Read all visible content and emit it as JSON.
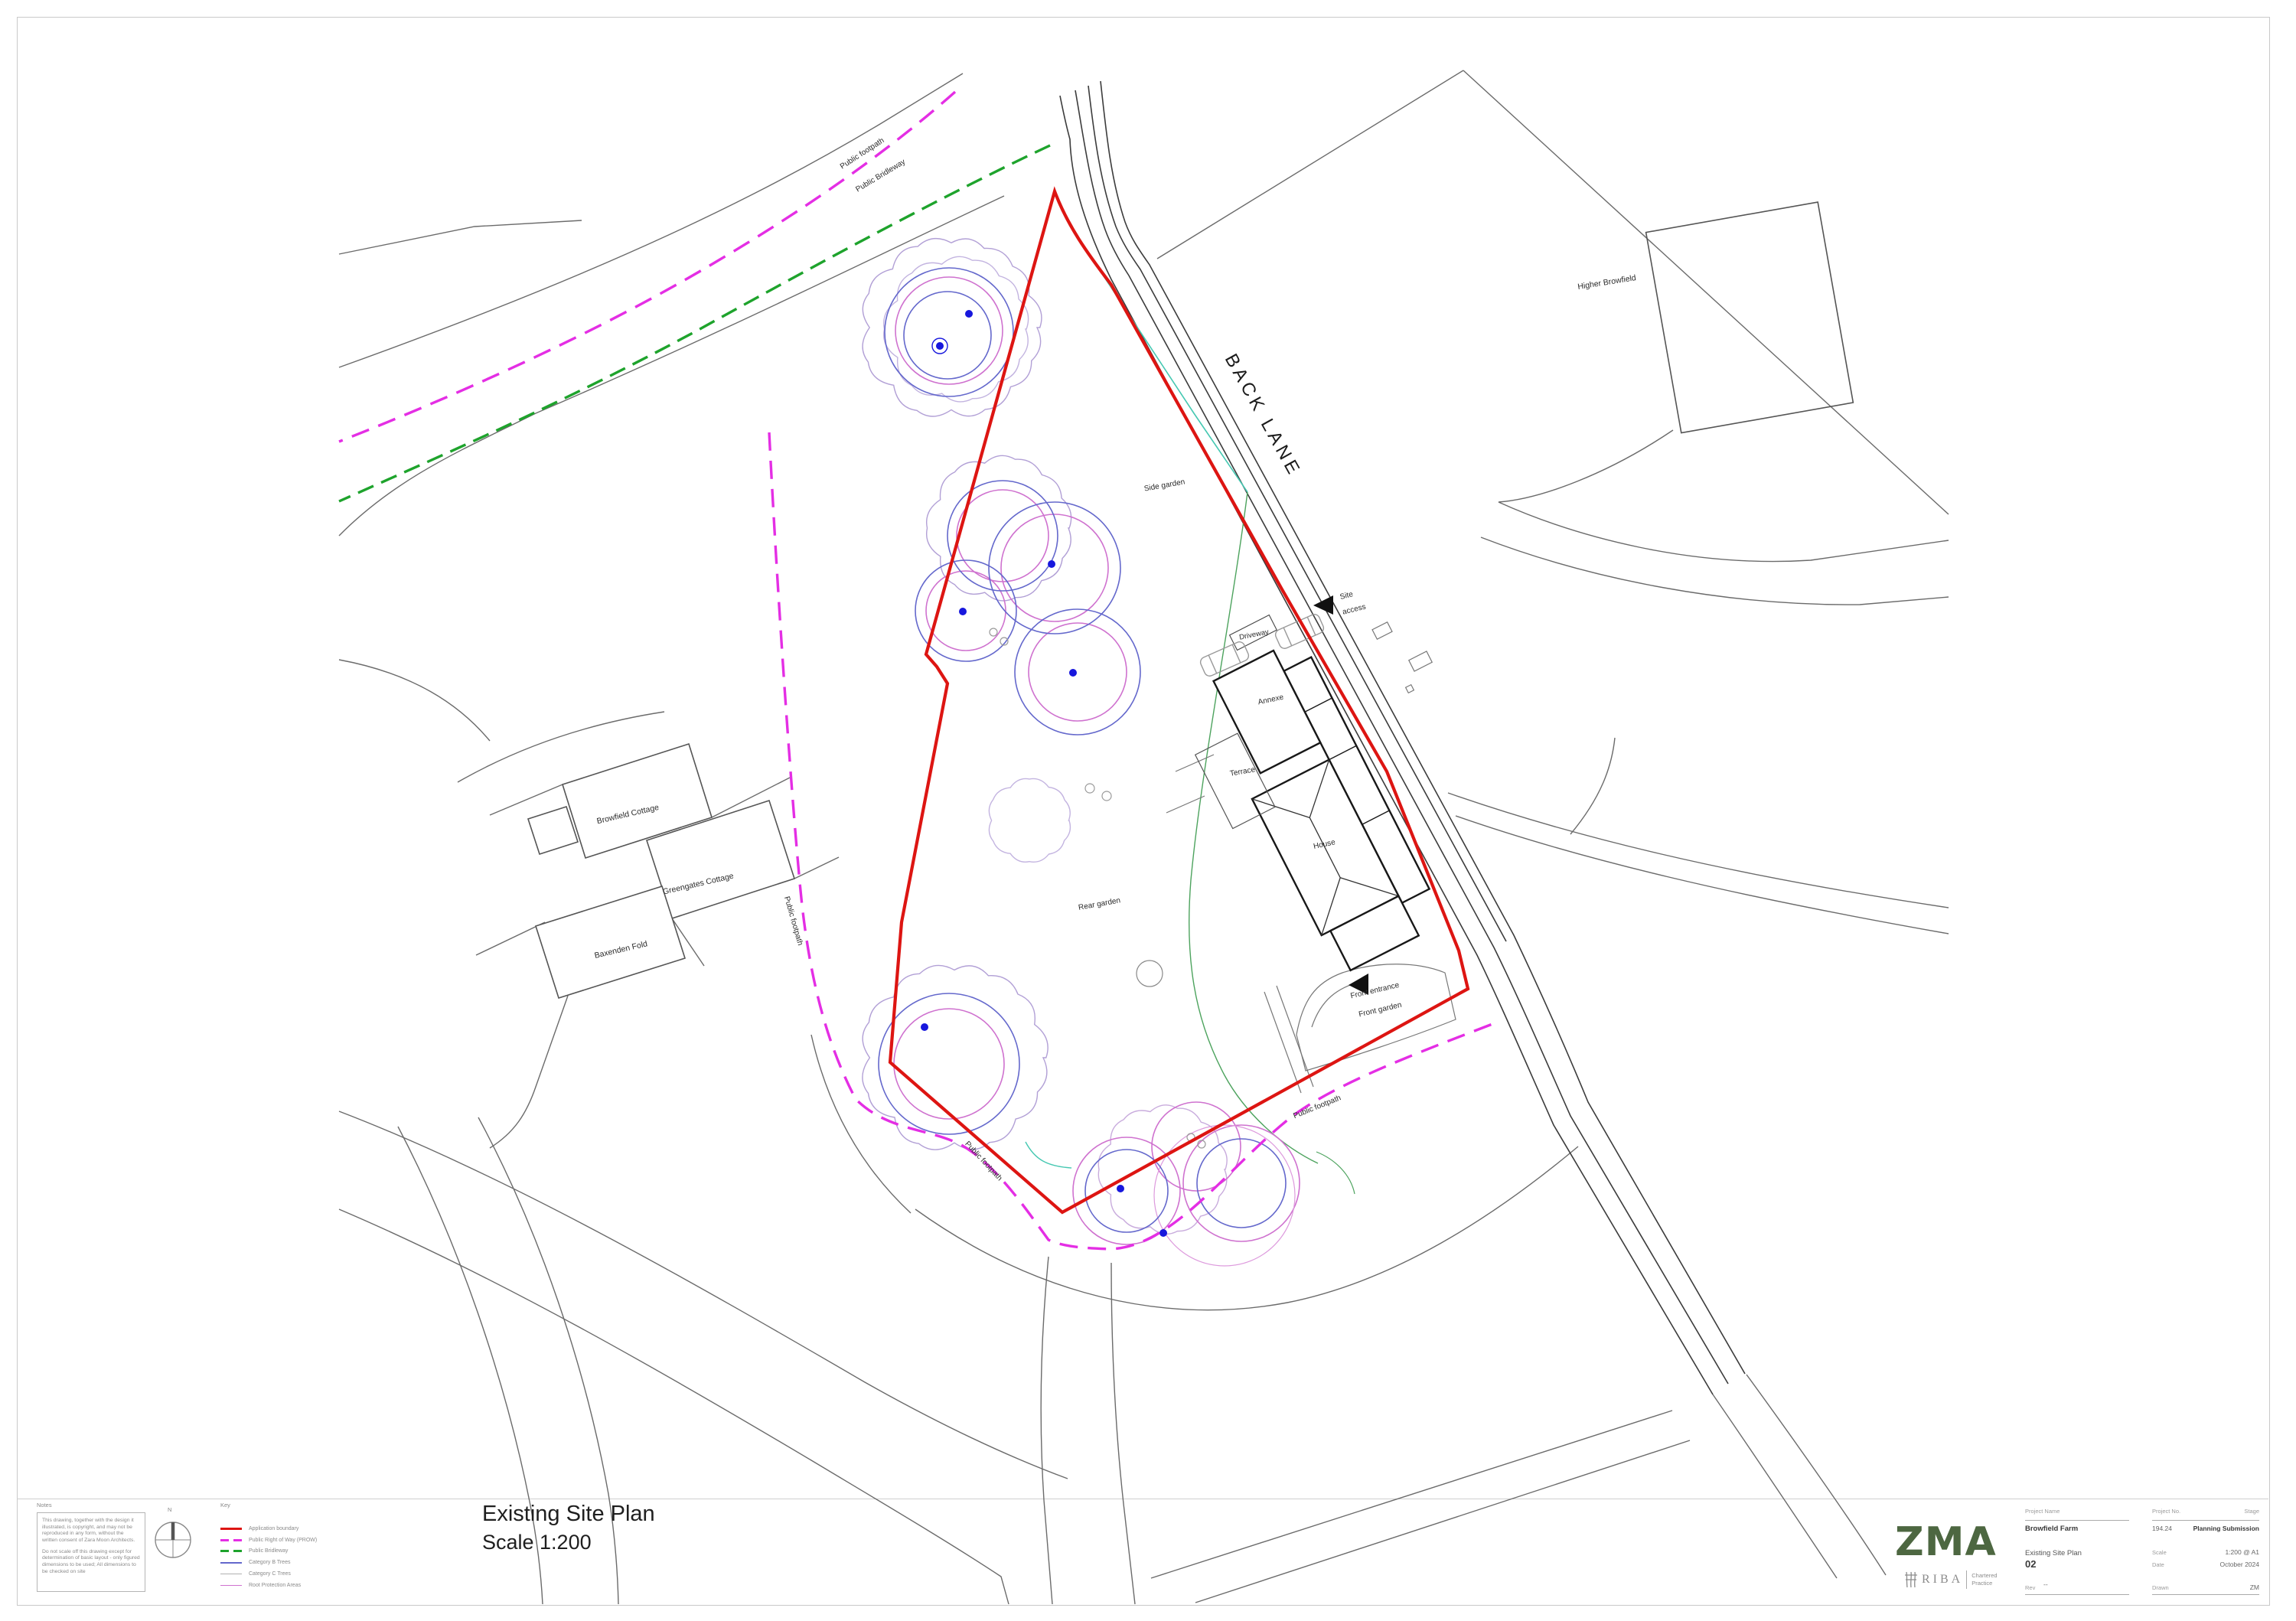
{
  "sheet": {
    "plan_title": "Existing Site Plan",
    "plan_scale": "Scale 1:200"
  },
  "map_labels": {
    "back_lane": "BACK LANE",
    "higher_browfield": "Higher Browfield",
    "side_garden": "Side garden",
    "rear_garden": "Rear garden",
    "annexe": "Annexe",
    "terrace": "Terrace",
    "house": "House",
    "driveway": "Driveway",
    "front_entrance": "Front entrance",
    "front_garden": "Front garden",
    "site_access_line1": "Site",
    "site_access_line2": "access",
    "browfield_cottage": "Browfield Cottage",
    "greengates_cottage": "Greengates Cottage",
    "baxenden_fold": "Baxenden Fold",
    "public_footpath": "Public footpath",
    "public_bridleway": "Public Bridleway"
  },
  "notes": {
    "heading": "Notes",
    "para1": "This drawing, together with the design it illustrated, is copyright, and may not be reproduced in any form, without the written consent of Zara Moon Architects.",
    "para2": "Do not scale off this drawing except for determination of basic layout - only figured dimensions to be used; All dimensions to be checked on site"
  },
  "compass": {
    "north_label": "N"
  },
  "key": {
    "heading": "Key",
    "items": [
      {
        "label": "Application boundary",
        "color": "#dd1512",
        "style": "solid",
        "weight": 3
      },
      {
        "label": "Public Right of Way (PROW)",
        "color": "#e42ee4",
        "style": "dashed",
        "weight": 3
      },
      {
        "label": "Public Bridleway",
        "color": "#1ea32c",
        "style": "dashed",
        "weight": 3
      },
      {
        "label": "Category B Trees",
        "color": "#6468cc",
        "style": "solid",
        "weight": 1.5
      },
      {
        "label": "Category C Trees",
        "color": "#b0b0b0",
        "style": "solid",
        "weight": 1
      },
      {
        "label": "Root Protection Areas",
        "color": "#cf72cf",
        "style": "solid",
        "weight": 1.5
      }
    ]
  },
  "branding": {
    "logo_text": "ZMA",
    "logo_color": "#4d6741",
    "riba_text": "RIBA",
    "riba_suffix_line1": "Chartered",
    "riba_suffix_line2": "Practice"
  },
  "title_block": {
    "project_name_label": "Project Name",
    "project_name": "Browfield Farm",
    "project_no_label": "Project No.",
    "project_no": "194.24",
    "stage_label": "Stage",
    "stage": "Planning Submission",
    "drawing_title": "Existing Site Plan",
    "drawing_no": "02",
    "scale_label": "Scale",
    "scale": "1:200 @ A1",
    "date_label": "Date",
    "date": "October 2024",
    "rev_label": "Rev",
    "rev": "--",
    "drawn_label": "Drawn",
    "drawn": "ZM"
  }
}
